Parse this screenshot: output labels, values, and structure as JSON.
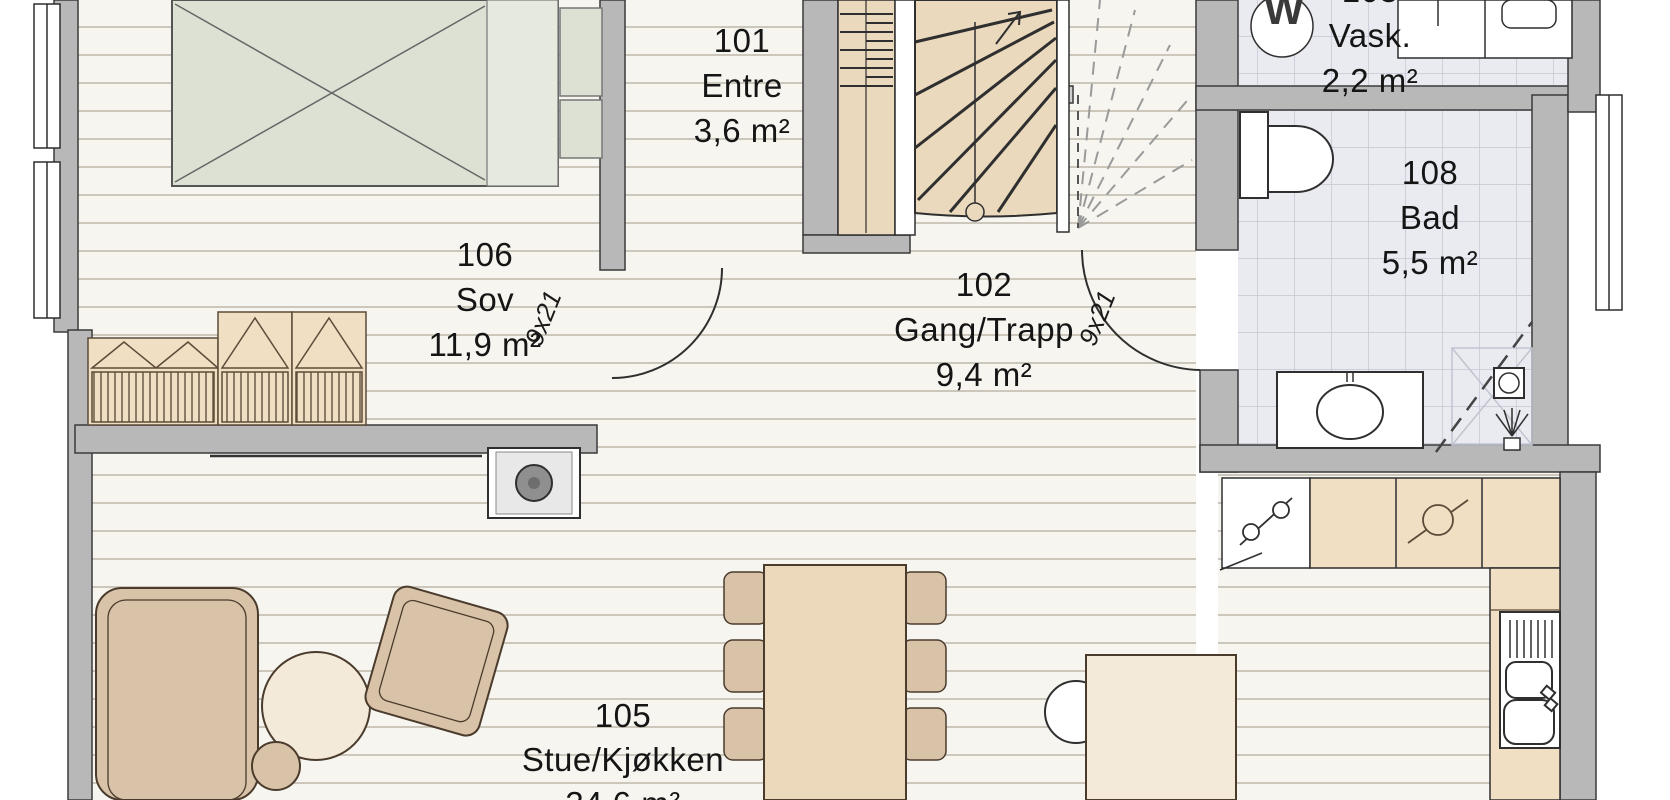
{
  "plan": {
    "title": "floor-plan",
    "rooms": [
      {
        "number": "101",
        "name": "Entre",
        "area": "3,6 m²"
      },
      {
        "number": "102",
        "name": "Gang/Trapp",
        "area": "9,4 m²"
      },
      {
        "number": "103",
        "name": "Vask.",
        "area": "2,2 m²"
      },
      {
        "number": "105",
        "name": "Stue/Kjøkken",
        "area": "34,6 m²"
      },
      {
        "number": "106",
        "name": "Sov",
        "area": "11,9 m²"
      },
      {
        "number": "108",
        "name": "Bad",
        "area": "5,5 m²"
      }
    ],
    "door_labels": {
      "sov_door": "9x21",
      "bad_door": "9x21"
    },
    "appliances": {
      "washer_label": "W"
    },
    "colors": {
      "floor_wood": "#f7f5ef",
      "plank_line": "#ccc7ba",
      "tile_floor": "#e9ebf1",
      "tile_line": "#c4c8d4",
      "wall_fill": "#b8b8b8",
      "wall_edge": "#3a3a3a",
      "stair_wood": "#ead9bd",
      "counter_tan": "#f0dfc3",
      "furniture_tan": "#d9c3a8",
      "bed_fill": "#dde1d3",
      "outline_dark": "#2f2f2f"
    }
  }
}
